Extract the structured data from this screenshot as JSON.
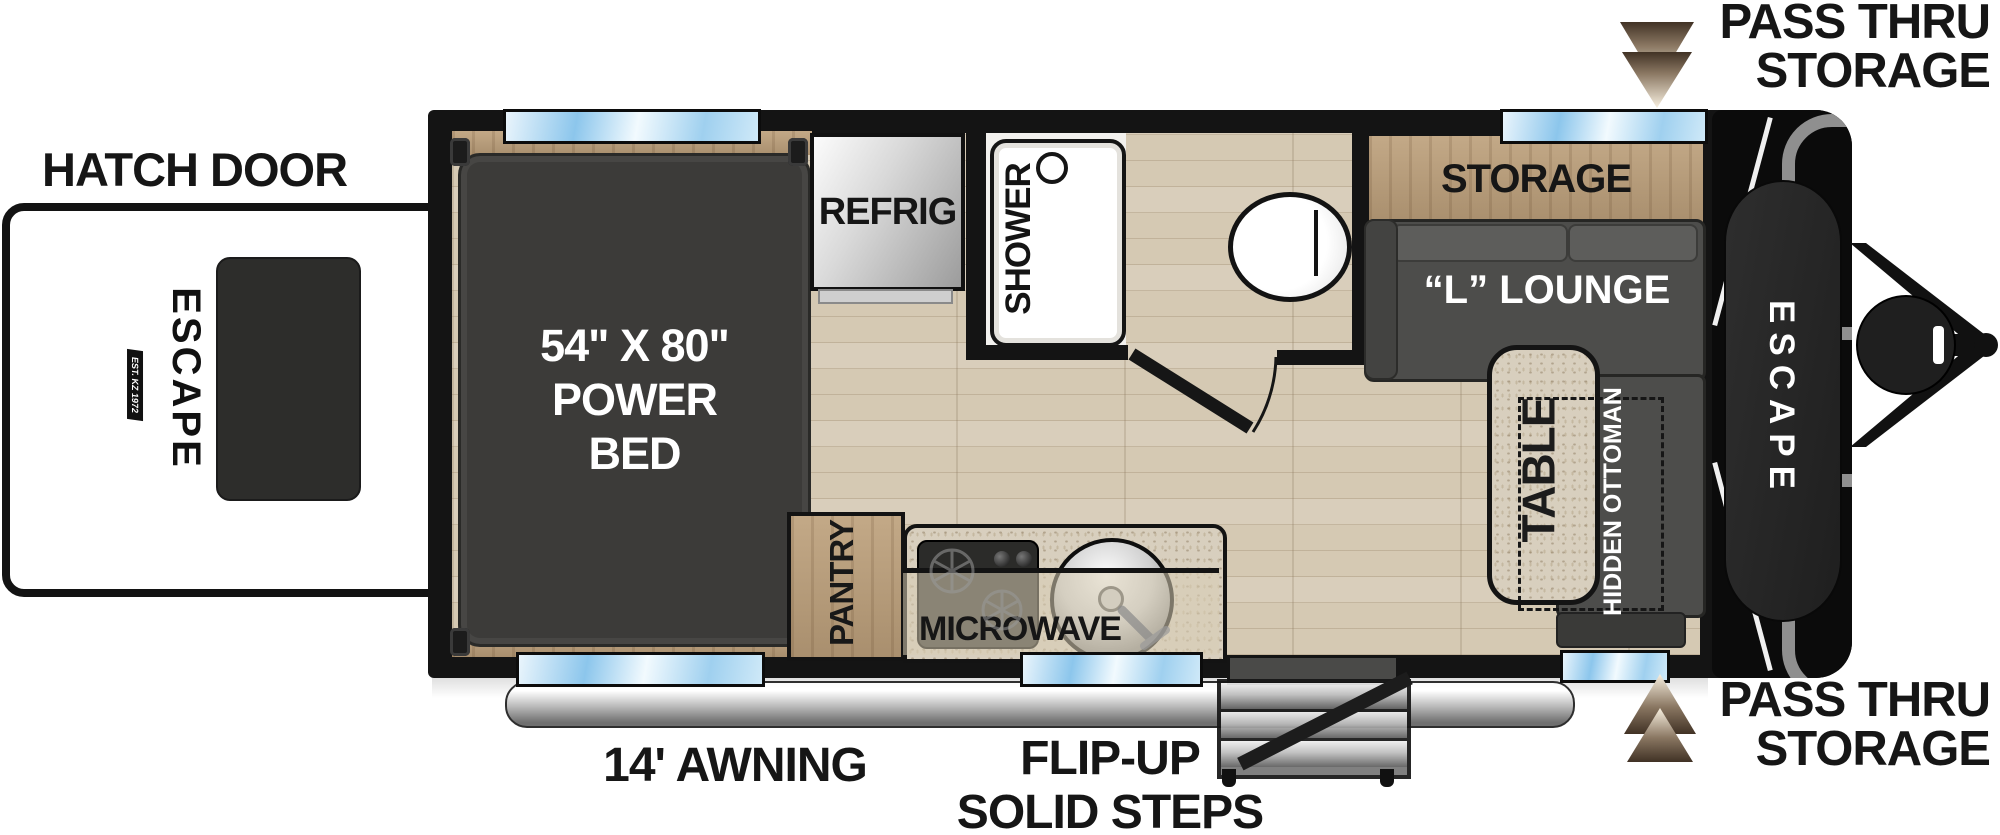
{
  "exterior": {
    "hatch_door_label": "HATCH DOOR",
    "awning_label": "14' AWNING",
    "steps_label_line1": "FLIP-UP",
    "steps_label_line2": "SOLID STEPS",
    "pass_thru_top": {
      "line1": "PASS THRU",
      "line2": "STORAGE"
    },
    "pass_thru_bottom": {
      "line1": "PASS THRU",
      "line2": "STORAGE"
    }
  },
  "floorplan": {
    "bed": {
      "size_line": "54\" X 80\"",
      "type_line1": "POWER",
      "type_line2": "BED"
    },
    "refrig_label": "REFRIG",
    "shower_label": "SHOWER",
    "pantry_label": "PANTRY",
    "microwave_label": "MICROWAVE",
    "storage_label": "STORAGE",
    "lounge_label": "“L” LOUNGE",
    "table_label": "TABLE",
    "ottoman_label": "HIDDEN OTTOMAN"
  },
  "branding": {
    "hatch_logo": "ESCAPE",
    "front_logo": "ESCAPE",
    "badge": "EST. KZ 1972"
  },
  "colors": {
    "wall": "#141414",
    "floor_wood": "#d5c9b3",
    "cabinet_wood": "#b79d7e",
    "window_blue": "#8cc6ec",
    "bed_gray": "#3c3b39",
    "sofa_gray": "#4d4d4b",
    "granite": "#d8cfbe",
    "arrow_dark": "#413225",
    "arrow_light": "#f8f0e0"
  }
}
